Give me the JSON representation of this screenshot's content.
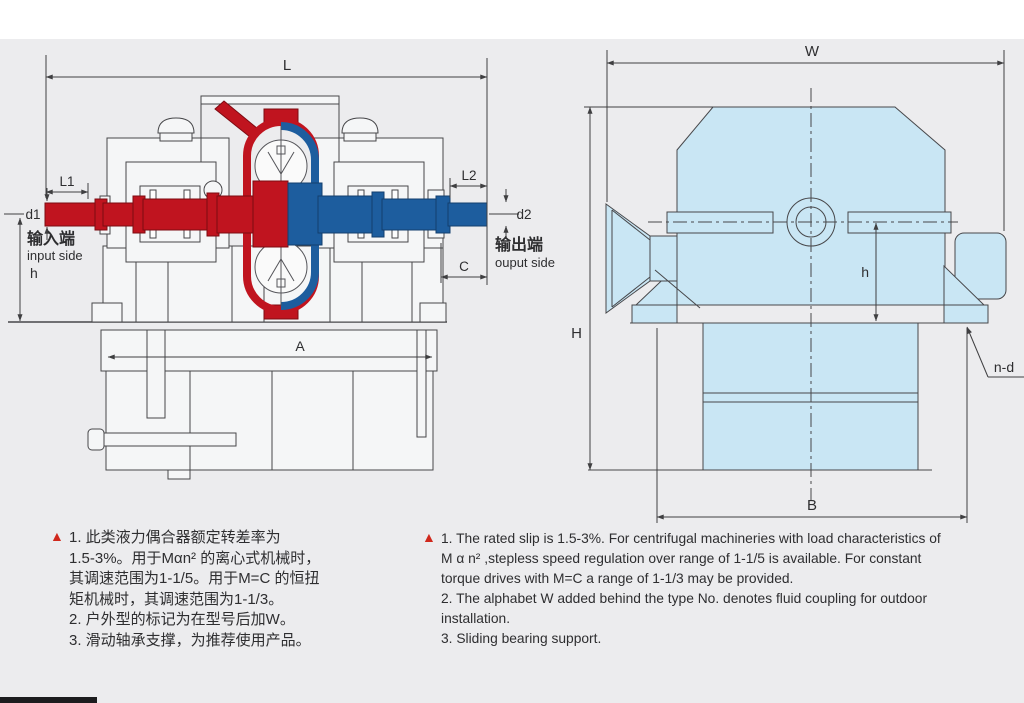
{
  "colors": {
    "background": "#ececee",
    "line": "#3f3f41",
    "machine_fill": "#f5f6f7",
    "red_shaft": "#c0141f",
    "blue_shaft": "#1d5d9e",
    "light_blue_fill": "#c9e6f4",
    "note_marker_red": "#d0281c"
  },
  "left_view": {
    "dim_labels": {
      "L": "L",
      "L1": "L1",
      "L2": "L2",
      "d1": "d1",
      "d2": "d2",
      "h": "h",
      "C": "C",
      "A": "A"
    },
    "input_label_cn": "输入端",
    "input_label_en": "input side",
    "output_label_cn": "输出端",
    "output_label_en": "ouput side"
  },
  "right_view": {
    "dim_labels": {
      "W": "W",
      "H": "H",
      "h": "h",
      "B": "B",
      "n_d": "n-d"
    }
  },
  "notes_cn": {
    "marker": "▲",
    "lines": [
      "1. 此类液力偶合器额定转差率为",
      "1.5-3%。用于Mαn² 的离心式机械时，",
      "其调速范围为1-1/5。用于M=C 的恒扭",
      "矩机械时，其调速范围为1-1/3。",
      "2. 户外型的标记为在型号后加W。",
      "3. 滑动轴承支撑，为推荐使用产品。"
    ]
  },
  "notes_en": {
    "marker": "▲",
    "lines": [
      "1. The rated slip is 1.5-3%. For centrifugal machineries with load characteristics of",
      "M α n² ,stepless speed regulation over range of 1-1/5 is available. For constant",
      "torque drives with M=C a range of 1-1/3 may be provided.",
      "2. The alphabet W added behind the type No. denotes fluid coupling for outdoor",
      "installation.",
      "3. Sliding bearing support."
    ]
  }
}
